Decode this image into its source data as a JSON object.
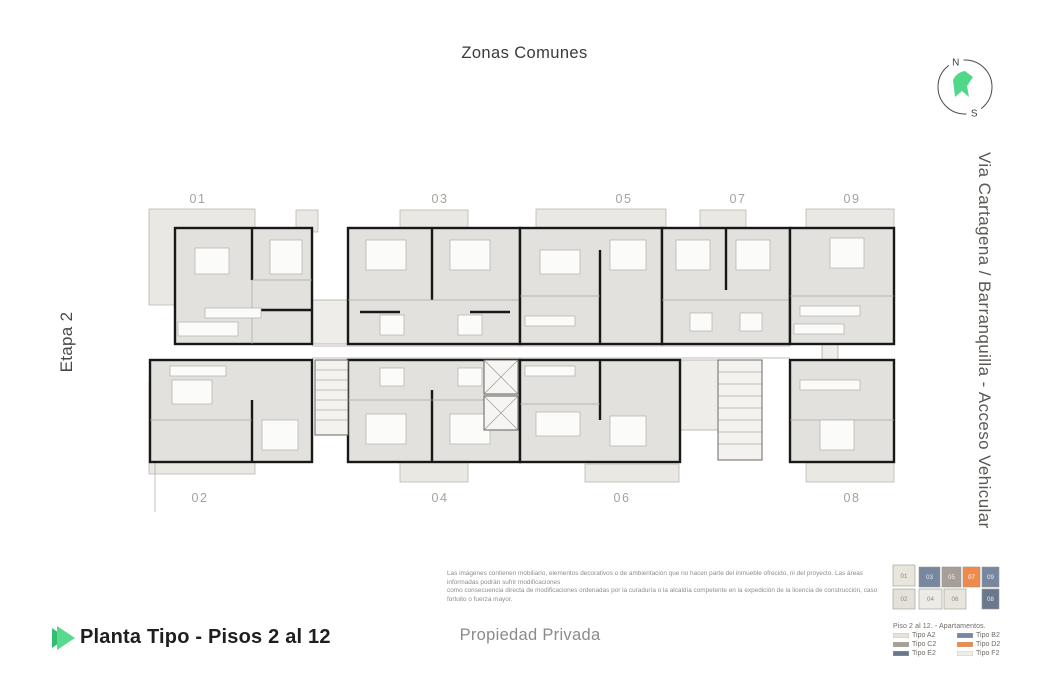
{
  "header": {
    "title": "Zonas Comunes"
  },
  "compass": {
    "north": "N",
    "south": "S",
    "needle_color": "#4fd88a"
  },
  "side_labels": {
    "left": "Etapa 2",
    "right": "Via Cartagena / Barranquilla - Acceso Vehicular"
  },
  "floor_plan": {
    "top_units": [
      "01",
      "03",
      "05",
      "07",
      "09"
    ],
    "bottom_units": [
      "02",
      "04",
      "06",
      "08"
    ]
  },
  "disclaimer": {
    "line1": "Las imágenes contienen mobiliario, elementos decorativos o de ambientación que no hacen parte del inmueble ofrecido, ni del proyecto. Las áreas informadas podrán sufrir modificaciones",
    "line2": "como consecuencia directa de modificaciones ordenadas por la curaduría o la alcaldía competente en la expedición de la licencia de construcción, caso fortuito o fuerza mayor."
  },
  "legend": {
    "title": "Piso 2 al 12. - Apartamentos.",
    "items": [
      {
        "label": "Tipo A2",
        "color": "#e6e3db"
      },
      {
        "label": "Tipo B2",
        "color": "#76879f"
      },
      {
        "label": "Tipo C2",
        "color": "#a59f98"
      },
      {
        "label": "Tipo D2",
        "color": "#ef8a4d"
      },
      {
        "label": "Tipo E2",
        "color": "#69788e"
      },
      {
        "label": "Tipo F2",
        "color": "#efede8"
      }
    ],
    "mini_plan": {
      "top": [
        {
          "num": "01",
          "color": "#e8e5dd",
          "text_color": "#90897f"
        },
        {
          "num": "03",
          "color": "#76879f",
          "text_color": "#e8ebf1"
        },
        {
          "num": "05",
          "color": "#a59f98",
          "text_color": "#f2f0ec"
        },
        {
          "num": "07",
          "color": "#ef8a4d",
          "text_color": "#ffffff"
        },
        {
          "num": "09",
          "color": "#76879f",
          "text_color": "#e8ebf1"
        }
      ],
      "bottom": [
        {
          "num": "02",
          "color": "#e4e1da",
          "text_color": "#90897f"
        },
        {
          "num": "04",
          "color": "#edebe5",
          "text_color": "#90897f"
        },
        {
          "num": "06",
          "color": "#e8e5de",
          "text_color": "#90897f"
        },
        {
          "num": "08",
          "color": "#69788e",
          "text_color": "#e8ebf1"
        }
      ]
    }
  },
  "footer": {
    "title": "Planta Tipo - Pisos 2 al 12",
    "center_label": "Propiedad Privada",
    "accent_dark": "#2fbf71",
    "accent_light": "#55da8e"
  }
}
